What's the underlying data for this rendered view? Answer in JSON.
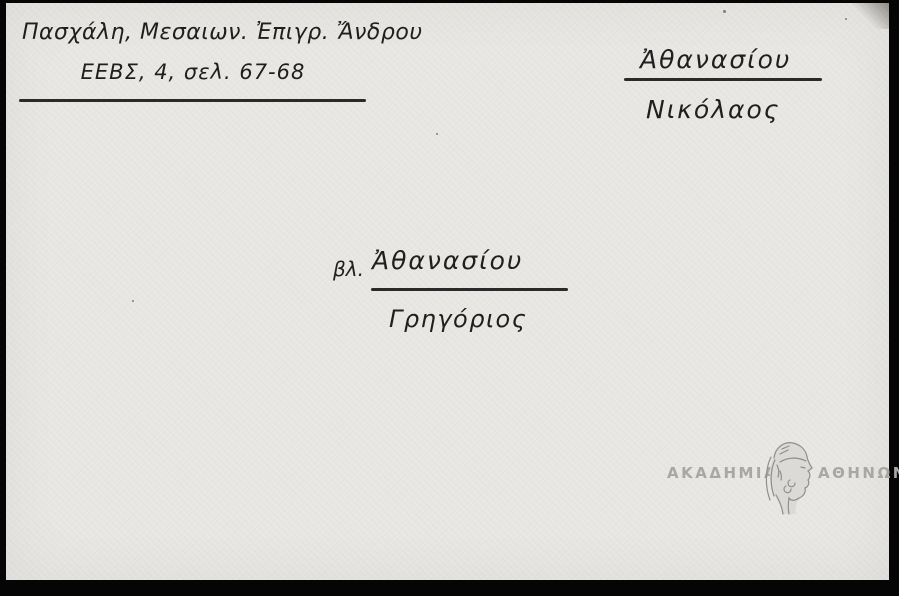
{
  "card": {
    "reference": {
      "line1": "Πασχάλη, Μεσαιων. Ἐπιγρ. Ἄνδρου",
      "line2": "ΕΕΒΣ, 4, σελ. 67-68"
    },
    "heading": {
      "surname": "Ἀθανασίου",
      "given_name": "Νικόλαος"
    },
    "cross_reference": {
      "see_abbreviation": "βλ.",
      "surname": "Ἀθανασίου",
      "given_name": "Γρηγόριος"
    },
    "stamp": {
      "left_text": "ΑΚΑΔΗΜΙΑ",
      "right_text": "ΑΘΗΝΩΝ",
      "emblem_icon": "athena-head-emblem"
    },
    "colors": {
      "paper": "#e9e8e5",
      "ink": "#1f1f1f",
      "frame": "#050505",
      "stamp_gray": "#a8a7a3"
    }
  }
}
